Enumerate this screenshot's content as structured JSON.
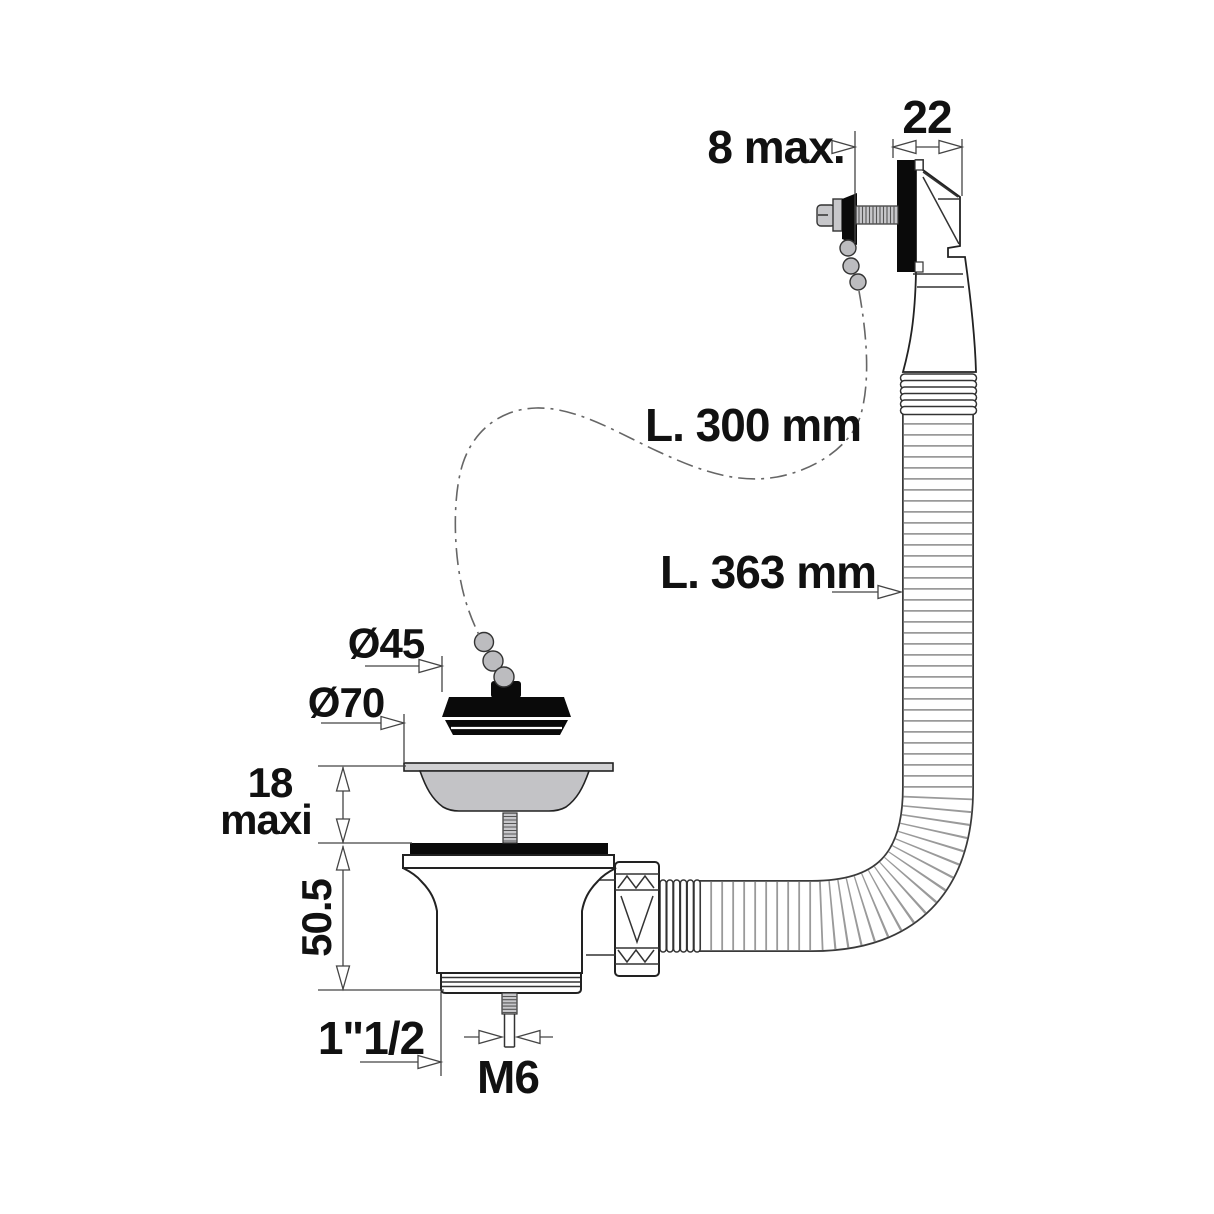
{
  "labels": {
    "overflow_width": "22",
    "panel_thickness": "8 max.",
    "chain_length": "L. 300 mm",
    "hose_length": "L. 363 mm",
    "plug_diameter": "Ø45",
    "grid_diameter": "Ø70",
    "deck_thickness_line1": "18",
    "deck_thickness_line2": "maxi",
    "body_height": "50.5",
    "outlet_thread": "1\"1/2",
    "screw_thread": "M6"
  },
  "colors": {
    "line": "#222222",
    "dimension_line": "#444444",
    "solid_black": "#0a0a0a",
    "metal_gray": "#c7c7ca",
    "basket_gray": "#c3c3c6",
    "flange_gray": "#d1d1d3",
    "bead_gray": "#bcbcbf",
    "hose_rib_gray": "#9a9a9a",
    "background": "#ffffff"
  }
}
